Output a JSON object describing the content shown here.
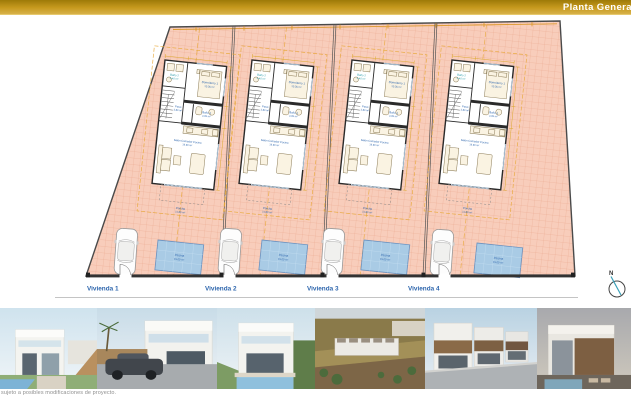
{
  "header": {
    "title": "Planta General"
  },
  "plan": {
    "units": [
      {
        "label": "Vivienda 1"
      },
      {
        "label": "Vivienda 2"
      },
      {
        "label": "Vivienda 3"
      },
      {
        "label": "Vivienda 4"
      }
    ],
    "rooms": {
      "bano2": {
        "name": "Baño 2",
        "area": "3.40 m²"
      },
      "dormitorio1": {
        "name": "Dormitorio 1",
        "area": "10.35 m²"
      },
      "paso": {
        "name": "Paso",
        "area": "3.80 m²"
      },
      "bano1": {
        "name": "Baño 1",
        "area": "4.05 m²"
      },
      "salon": {
        "name": "Salón Comedor Cocina",
        "area": "19.90 m²"
      },
      "porche": {
        "name": "Porche",
        "area": "11.80 m²"
      },
      "piscina": {
        "name": "Piscina",
        "area": "15.00 m²"
      }
    },
    "north_label": "N"
  },
  "footer": {
    "disclaimer": "sujeto a posibles modificaciones de proyecto."
  },
  "colors": {
    "header_bar": "#c79a1e",
    "plot_ground": "#f8cdbb",
    "plot_grid": "#eba78d",
    "pool_fill": "#a9cbe5",
    "label_blue": "#2e66ad",
    "dimension_orange": "#e8a838"
  }
}
